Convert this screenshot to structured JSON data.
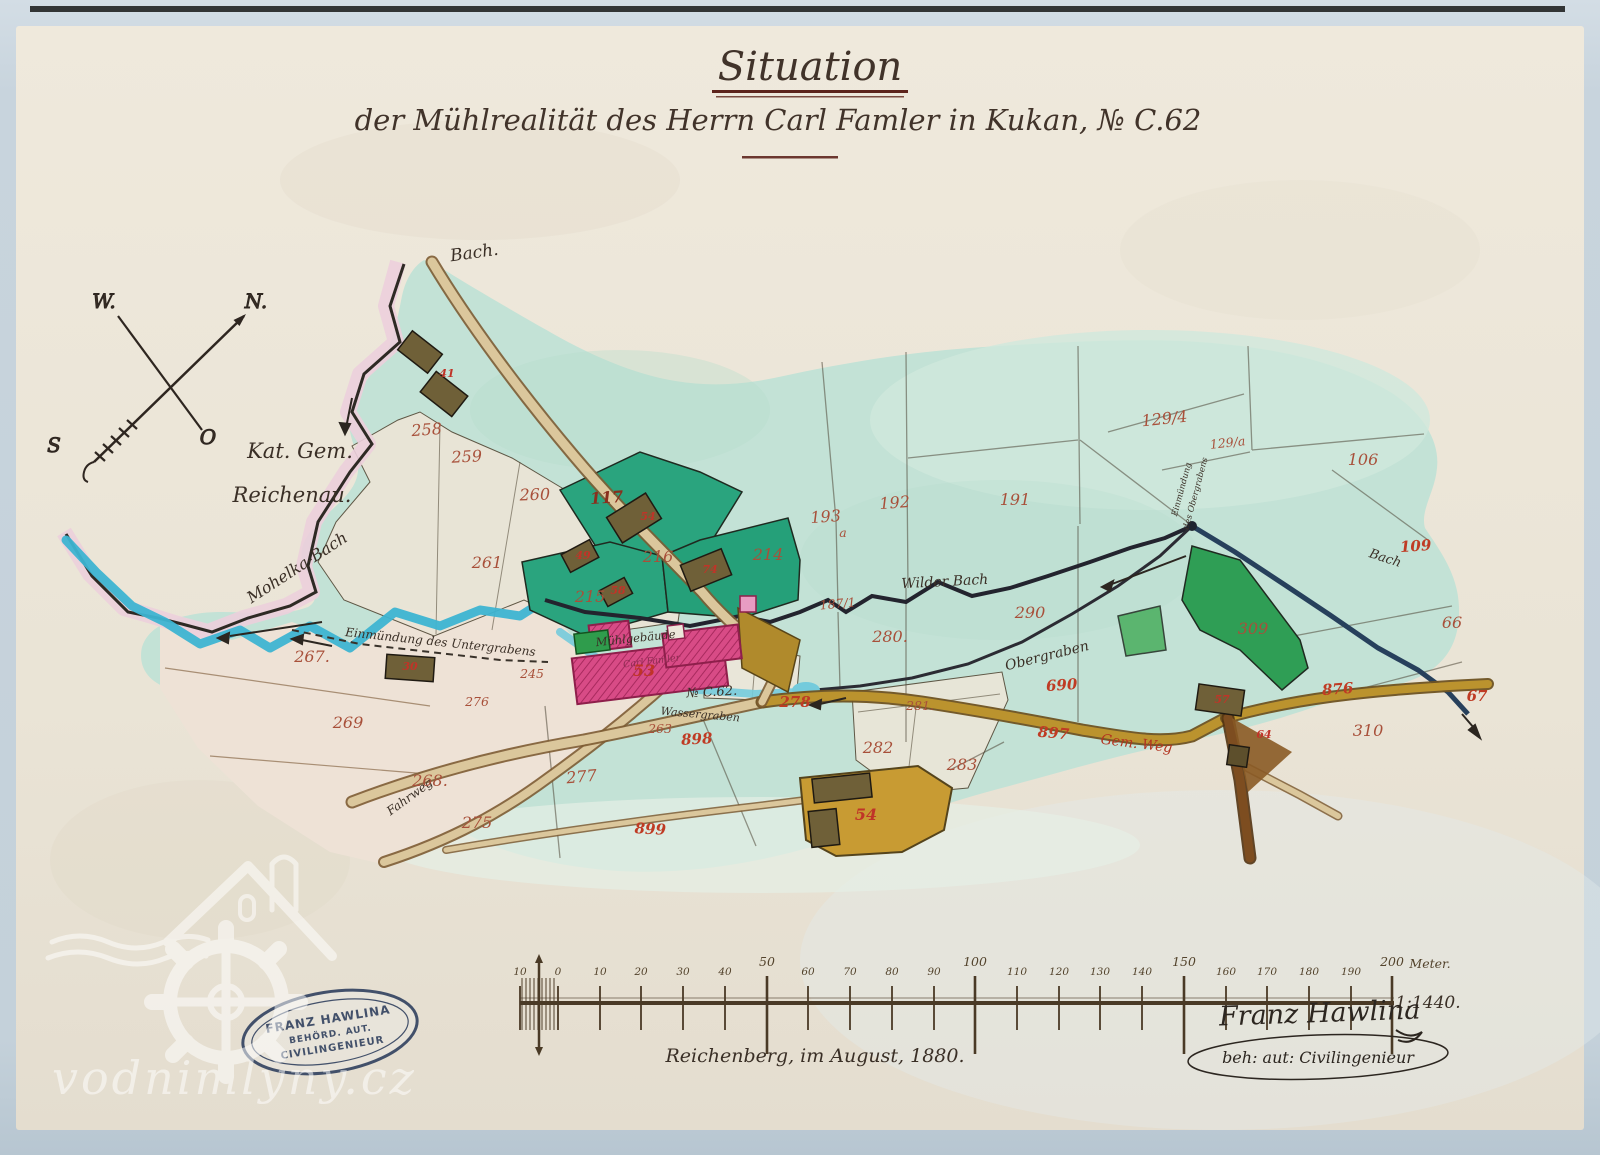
{
  "title": {
    "line1": "Situation",
    "line2": "der Mühlrealität des Herrn Carl Famler in Kukan, № C.62"
  },
  "compass": {
    "north": "N.",
    "west": "W.",
    "east": "O",
    "south": "S"
  },
  "map": {
    "area_labels": [
      {
        "t": "Bach.",
        "x": 475,
        "y": 258,
        "s": 17,
        "rot": -8
      },
      {
        "t": "Kat. Gem.",
        "x": 300,
        "y": 458,
        "s": 21
      },
      {
        "t": "Reichenau.",
        "x": 292,
        "y": 502,
        "s": 21
      },
      {
        "t": "Mohelka-Bach",
        "x": 300,
        "y": 572,
        "s": 16,
        "rot": -33
      },
      {
        "t": "Wilder Bach",
        "x": 945,
        "y": 586,
        "s": 14,
        "rot": -3
      },
      {
        "t": "Obergraben",
        "x": 1048,
        "y": 660,
        "s": 14,
        "rot": -14
      },
      {
        "t": "Einmündung",
        "x": 1184,
        "y": 490,
        "s": 8.5,
        "rot": -75
      },
      {
        "t": "des Obergrabens",
        "x": 1198,
        "y": 494,
        "s": 8.5,
        "rot": -75
      },
      {
        "t": "Mühlgebäude",
        "x": 636,
        "y": 642,
        "s": 11.5,
        "rot": -6
      },
      {
        "t": "Carl Famler",
        "x": 652,
        "y": 664,
        "s": 9.5,
        "rot": -7,
        "k": "scrP"
      },
      {
        "t": "№ C.62.",
        "x": 712,
        "y": 696,
        "s": 13,
        "rot": -3
      },
      {
        "t": "Wassergraben",
        "x": 700,
        "y": 718,
        "s": 11,
        "rot": 5
      },
      {
        "t": "Einmündung des Untergrabens",
        "x": 440,
        "y": 646,
        "s": 12,
        "rot": 6
      },
      {
        "t": "Gem. Weg",
        "x": 1136,
        "y": 748,
        "s": 14,
        "rot": 7,
        "k": "scrR"
      },
      {
        "t": "Fahrweg",
        "x": 412,
        "y": 800,
        "s": 12,
        "rot": -36
      },
      {
        "t": "Bach",
        "x": 1384,
        "y": 562,
        "s": 13,
        "rot": 18
      }
    ],
    "parcel_numbers": [
      {
        "t": "258",
        "x": 427,
        "y": 435,
        "k": "lp",
        "rot": -4
      },
      {
        "t": "259",
        "x": 467,
        "y": 462,
        "k": "lp",
        "rot": -3
      },
      {
        "t": "260",
        "x": 535,
        "y": 500,
        "k": "lp",
        "rot": -2
      },
      {
        "t": "261",
        "x": 487,
        "y": 568,
        "k": "lp"
      },
      {
        "t": "117",
        "x": 607,
        "y": 503,
        "k": "lp lpD",
        "rot": -4
      },
      {
        "t": "216",
        "x": 658,
        "y": 562,
        "k": "lp"
      },
      {
        "t": "214",
        "x": 768,
        "y": 560,
        "k": "lp"
      },
      {
        "t": "215",
        "x": 590,
        "y": 602,
        "k": "lp"
      },
      {
        "t": "192",
        "x": 895,
        "y": 508,
        "k": "lp",
        "rot": -4
      },
      {
        "t": "193",
        "x": 826,
        "y": 522,
        "k": "lp",
        "rot": -4
      },
      {
        "t": "a",
        "x": 843,
        "y": 537,
        "k": "lp lp2"
      },
      {
        "t": "191",
        "x": 1015,
        "y": 505,
        "k": "lp"
      },
      {
        "t": "187/1",
        "x": 838,
        "y": 608,
        "k": "lp lp2",
        "rot": -5
      },
      {
        "t": "129/4",
        "x": 1165,
        "y": 424,
        "k": "lp",
        "rot": -6
      },
      {
        "t": "129/a",
        "x": 1228,
        "y": 447,
        "k": "lp lp2",
        "rot": -6
      },
      {
        "t": "106",
        "x": 1363,
        "y": 465,
        "k": "lp"
      },
      {
        "t": "109",
        "x": 1416,
        "y": 551,
        "k": "lr",
        "rot": -4
      },
      {
        "t": "66",
        "x": 1452,
        "y": 628,
        "k": "lp"
      },
      {
        "t": "290",
        "x": 1030,
        "y": 618,
        "k": "lp"
      },
      {
        "t": "280.",
        "x": 890,
        "y": 642,
        "k": "lp"
      },
      {
        "t": "309",
        "x": 1253,
        "y": 634,
        "k": "lp"
      },
      {
        "t": "310",
        "x": 1368,
        "y": 736,
        "k": "lp"
      },
      {
        "t": "267.",
        "x": 312,
        "y": 662,
        "k": "lp"
      },
      {
        "t": "269",
        "x": 348,
        "y": 728,
        "k": "lp"
      },
      {
        "t": "268.",
        "x": 430,
        "y": 786,
        "k": "lp"
      },
      {
        "t": "275",
        "x": 477,
        "y": 828,
        "k": "lp"
      },
      {
        "t": "276",
        "x": 477,
        "y": 706,
        "k": "lp lp2"
      },
      {
        "t": "245",
        "x": 532,
        "y": 678,
        "k": "lp lp2"
      },
      {
        "t": "263",
        "x": 660,
        "y": 733,
        "k": "lp lp2"
      },
      {
        "t": "277",
        "x": 582,
        "y": 782,
        "k": "lp",
        "rot": -5
      },
      {
        "t": "282",
        "x": 878,
        "y": 753,
        "k": "lp"
      },
      {
        "t": "283",
        "x": 962,
        "y": 770,
        "k": "lp"
      },
      {
        "t": "281.",
        "x": 920,
        "y": 710,
        "k": "lp lp2"
      },
      {
        "t": "690",
        "x": 1062,
        "y": 690,
        "k": "lr",
        "rot": -4
      },
      {
        "t": "898",
        "x": 697,
        "y": 744,
        "k": "lr",
        "rot": -3
      },
      {
        "t": "278",
        "x": 795,
        "y": 707,
        "k": "lr"
      },
      {
        "t": "897",
        "x": 1053,
        "y": 738,
        "k": "lr",
        "rot": 5
      },
      {
        "t": "876",
        "x": 1338,
        "y": 694,
        "k": "lr",
        "rot": -4
      },
      {
        "t": "899",
        "x": 650,
        "y": 834,
        "k": "lr",
        "rot": 3
      },
      {
        "t": "67",
        "x": 1477,
        "y": 701,
        "k": "lr"
      },
      {
        "t": "41",
        "x": 447,
        "y": 377,
        "k": "lb"
      },
      {
        "t": "54",
        "x": 648,
        "y": 520,
        "k": "lb"
      },
      {
        "t": "49",
        "x": 583,
        "y": 559,
        "k": "lb"
      },
      {
        "t": "58",
        "x": 618,
        "y": 594,
        "k": "lb"
      },
      {
        "t": "74",
        "x": 710,
        "y": 573,
        "k": "lb"
      },
      {
        "t": "30",
        "x": 410,
        "y": 670,
        "k": "lb"
      },
      {
        "t": "53",
        "x": 644,
        "y": 676,
        "k": "lb lbBig"
      },
      {
        "t": "54",
        "x": 866,
        "y": 820,
        "k": "lb lbBig"
      },
      {
        "t": "57",
        "x": 1222,
        "y": 703,
        "k": "lb"
      },
      {
        "t": "64",
        "x": 1264,
        "y": 738,
        "k": "lb"
      }
    ]
  },
  "scale": {
    "ticks": [
      {
        "x": 520,
        "label": "10"
      },
      {
        "x": 558,
        "label": "0"
      },
      {
        "x": 600,
        "label": "10"
      },
      {
        "x": 641,
        "label": "20"
      },
      {
        "x": 683,
        "label": "30"
      },
      {
        "x": 725,
        "label": "40"
      },
      {
        "x": 767,
        "label": "50",
        "major": true
      },
      {
        "x": 808,
        "label": "60"
      },
      {
        "x": 850,
        "label": "70"
      },
      {
        "x": 892,
        "label": "80"
      },
      {
        "x": 934,
        "label": "90"
      },
      {
        "x": 975,
        "label": "100",
        "major": true
      },
      {
        "x": 1017,
        "label": "110"
      },
      {
        "x": 1059,
        "label": "120"
      },
      {
        "x": 1100,
        "label": "130"
      },
      {
        "x": 1142,
        "label": "140"
      },
      {
        "x": 1184,
        "label": "150",
        "major": true
      },
      {
        "x": 1226,
        "label": "160"
      },
      {
        "x": 1267,
        "label": "170"
      },
      {
        "x": 1309,
        "label": "180"
      },
      {
        "x": 1351,
        "label": "190"
      },
      {
        "x": 1392,
        "label": "200",
        "major": true
      }
    ],
    "unit_label": "Meter.",
    "ratio": "1:1440.",
    "place_date": "Reichenberg, im August, 1880."
  },
  "signature": {
    "name": "Franz Hawlina",
    "title": "beh: aut: Civilingenieur"
  },
  "stamp": {
    "line1": "FRANZ HAWLINA",
    "line2": "BEHÖRD. AUT.",
    "line3": "CIVILINGENIEUR"
  },
  "watermark": {
    "text": "vodnimlyny.cz"
  },
  "colors": {
    "photo_bg": "#c8d4dd",
    "paper": "#ebe5d8",
    "map_green": "#c3e2d6",
    "parcel_dark_green": "#2aa47e",
    "stream_blue": "#3db4d2",
    "road_tan": "#dbc79c",
    "road_dark_yellow": "#bb932e",
    "mill_pink": "#d84b86",
    "ink": "#3a2f26",
    "ink_red": "#a8503a",
    "stamp_blue": "#31415f"
  }
}
